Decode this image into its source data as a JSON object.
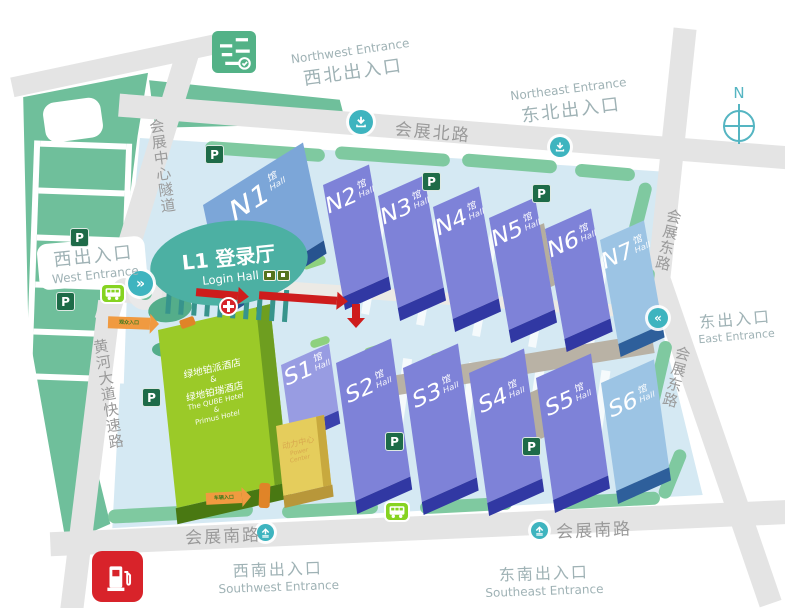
{
  "compass": {
    "label": "N"
  },
  "roads": {
    "north": "会展北路",
    "south": "会展南路",
    "east": "会展东路",
    "tunnel": "会展中心隧道",
    "expressway": "黄河大道快速路"
  },
  "entrances": {
    "northwest": {
      "zh": "西北出入口",
      "en": "Northwest Entrance"
    },
    "northeast": {
      "zh": "东北出入口",
      "en": "Northeast Entrance"
    },
    "west": {
      "zh": "西出入口",
      "en": "West Entrance"
    },
    "east": {
      "zh": "东出入口",
      "en": "East Entrance"
    },
    "southwest": {
      "zh": "西南出入口",
      "en": "Southwest Entrance"
    },
    "southeast": {
      "zh": "东南出入口",
      "en": "Southeast Entrance"
    }
  },
  "login_hall": {
    "zh": "L1 登录厅",
    "en": "Login Hall"
  },
  "halls_north": [
    {
      "num": "N1",
      "suffix": "馆",
      "sub": "Hall"
    },
    {
      "num": "N2",
      "suffix": "馆",
      "sub": "Hall"
    },
    {
      "num": "N3",
      "suffix": "馆",
      "sub": "Hall"
    },
    {
      "num": "N4",
      "suffix": "馆",
      "sub": "Hall"
    },
    {
      "num": "N5",
      "suffix": "馆",
      "sub": "Hall"
    },
    {
      "num": "N6",
      "suffix": "馆",
      "sub": "Hall"
    },
    {
      "num": "N7",
      "suffix": "馆",
      "sub": "Hall"
    }
  ],
  "halls_south": [
    {
      "num": "S1",
      "suffix": "馆",
      "sub": "Hall"
    },
    {
      "num": "S2",
      "suffix": "馆",
      "sub": "Hall"
    },
    {
      "num": "S3",
      "suffix": "馆",
      "sub": "Hall"
    },
    {
      "num": "S4",
      "suffix": "馆",
      "sub": "Hall"
    },
    {
      "num": "S5",
      "suffix": "馆",
      "sub": "Hall"
    },
    {
      "num": "S6",
      "suffix": "馆",
      "sub": "Hall"
    }
  ],
  "hotel": {
    "zh1": "绿地铂派酒店",
    "amp": "&",
    "zh2": "绿地铂瑞酒店",
    "en1": "The QUBE Hotel",
    "en_amp": "&",
    "en2": "Primus Hotel"
  },
  "power_center": {
    "zh": "动力中心",
    "en": "Power Center"
  },
  "markers": {
    "parking": "P",
    "west_gate_label": "观众入口",
    "south_gate_label": "车辆入口",
    "west_chevrons": "»",
    "east_chevrons": "«"
  },
  "colors": {
    "hall_purple": "#7e82d8",
    "hall_steel_blue": "#7ca6d8",
    "hall_pale_blue": "#9cc4e4",
    "hotel_green": "#9bca28",
    "power_yellow": "#e5cd5c",
    "login_teal": "#4cb0a3",
    "campus_blue": "#d5e9f3",
    "road_gray": "#e4e4e4",
    "green_zone": "#6fbf9b",
    "arrow_red": "#ce1c1c",
    "parking_green": "#1e6b48",
    "icon_teal": "#3eb4bf",
    "bus_green": "#86d321",
    "gas_red": "#d8232a",
    "cone_orange": "#e98b2e"
  }
}
